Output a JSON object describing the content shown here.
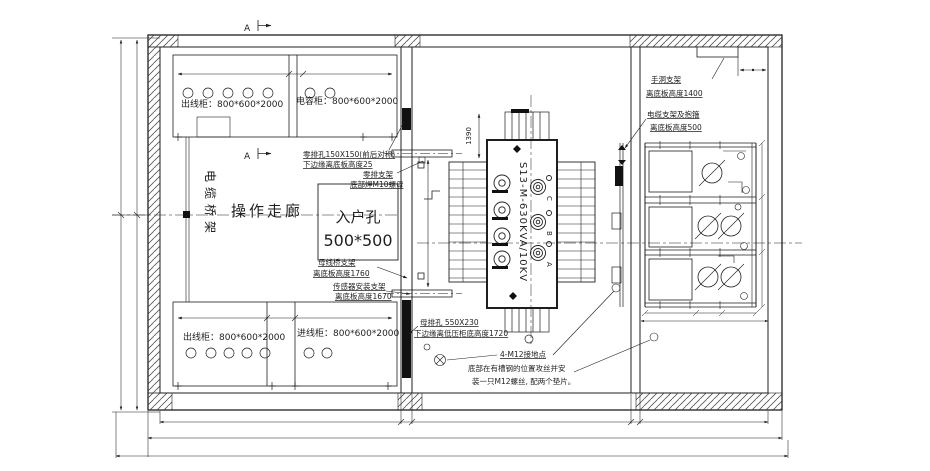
{
  "colors": {
    "ink": "#1f1f1f",
    "background": "#ffffff"
  },
  "drawing": {
    "section_marker_top": "A",
    "section_marker_mid": "A",
    "lv_room": {
      "cabinet_top_left": "出线柜：800*600*2000",
      "cabinet_top_right": "电容柜：800*600*2000",
      "cabinet_bottom_left": "出线柜：800*600*2000",
      "cabinet_bottom_right": "进线柜：800*600*2000",
      "corridor_label": "操作走廊",
      "cable_tray_label": "电缆桥架",
      "entry_hole_name": "入户孔",
      "entry_hole_size": "500*500"
    },
    "annotations": {
      "zero_bar_hole_line1": "零排孔150X150(前后对称)",
      "zero_bar_hole_line2": "下边缘离底板高度25",
      "zero_bar_bracket_line1": "零排支架",
      "zero_bar_bracket_line2": "底部焊M10螺母",
      "busbar_bridge_line1": "母线桥支架",
      "busbar_bridge_line2": "离底板高度1760",
      "sensor_bracket_line1": "传感器安装支架",
      "sensor_bracket_line2": "离底板高度1670",
      "busbar_hole_line1": "母排孔 550X230",
      "busbar_hole_line2": "下边缘离低压柜底高度1720",
      "grounding_line1": "4-M12接地点",
      "grounding_line2": "底部在有槽钢的位置攻丝并安",
      "grounding_line3": "装一只M12螺丝, 配两个垫片。",
      "hand_hole_line1": "手洞支架",
      "hand_hole_line2": "离底板高度1400",
      "cable_bracket_line1": "电缆支架及抱箍",
      "cable_bracket_line2": "离底板高度500"
    },
    "transformer": {
      "model": "S13-M-630KVA/10KV",
      "dim_height": "1390",
      "phase_c": "C",
      "phase_b": "B",
      "phase_a": "A"
    }
  }
}
